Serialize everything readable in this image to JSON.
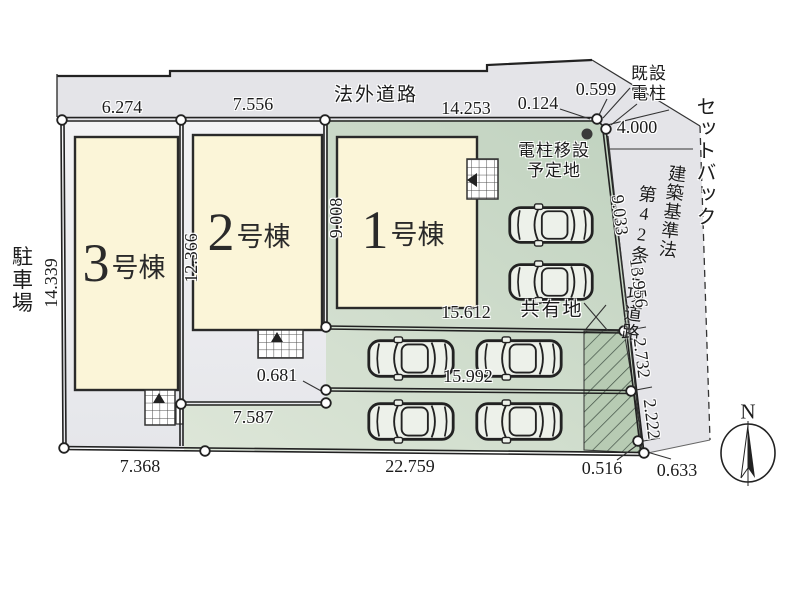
{
  "plan": {
    "road_top_label": "法外道路",
    "setback_label": "セットバック",
    "road_law_line": "建築基準法",
    "road_article_line": "第42条2項道路",
    "parking_label": "駐車場",
    "shared_label": "共有地",
    "pole_existing_line1": "既設",
    "pole_existing_line2": "電柱",
    "pole_relocate_line1": "電柱移設",
    "pole_relocate_line2": "予定地",
    "compass_north": "N",
    "buildings": [
      {
        "num": "1",
        "unit": "号棟"
      },
      {
        "num": "2",
        "unit": "号棟"
      },
      {
        "num": "3",
        "unit": "号棟"
      }
    ],
    "dims": {
      "top_left": "6.274",
      "top_mid": "7.556",
      "top_right": "14.253",
      "top_small": "0.124",
      "top_corner": "0.599",
      "road_width": "4.000",
      "road_seg1": "9.033",
      "road_seg2": "13.956",
      "road_seg3": "2.732",
      "road_seg4": "2.222",
      "corner_b1": "0.516",
      "corner_b2": "0.633",
      "left_edge": "14.339",
      "lot2_depth": "12.366",
      "lot1_depth": "9.008",
      "shared_width": "15.612",
      "offset_small": "0.681",
      "row_width": "15.992",
      "lot2_width": "7.587",
      "bottom_left": "7.368",
      "bottom_main": "22.759"
    },
    "colors": {
      "road": "#e4e4e8",
      "lot": "#eeeef1",
      "green": "#c9d8c6",
      "building": "#fbf5d8",
      "hatch": "#b7cbb3",
      "line": "#1e1e1e"
    }
  }
}
